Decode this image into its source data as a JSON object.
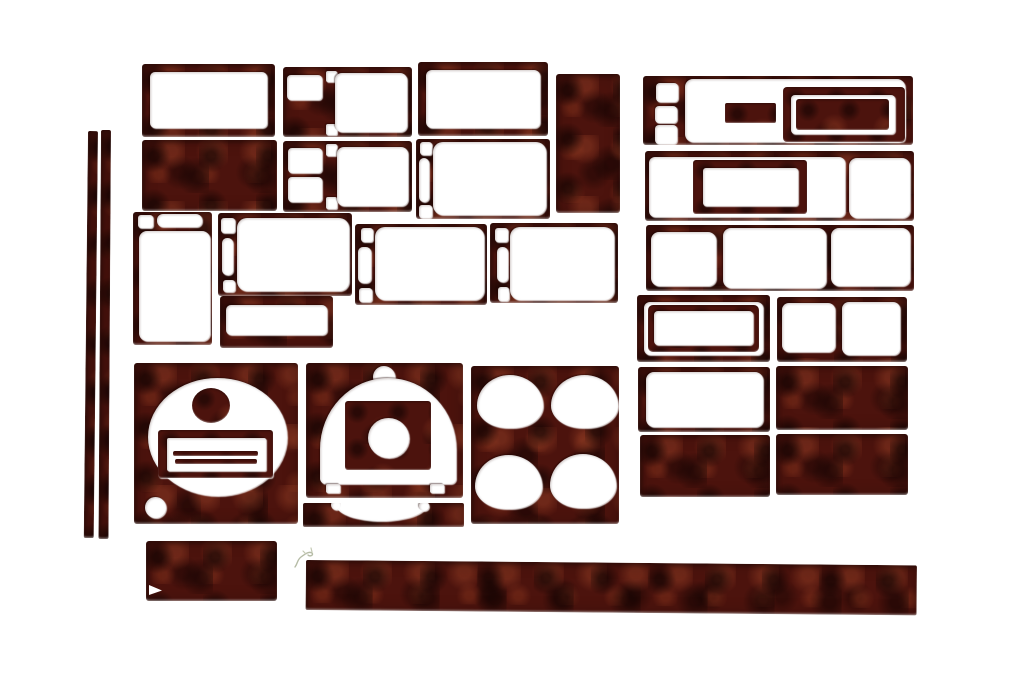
{
  "scene": {
    "type": "product-photo",
    "subject": "Glossy dark red burl wood-grain automotive dash trim kit, about 29 die-cut pieces arranged on a white background",
    "background_color": "#ffffff",
    "finish": {
      "name": "red burl walnut high-gloss",
      "base": "#4c130d",
      "shadow": "#1c0504",
      "mid": "#72281a",
      "highlight": "#9c4328",
      "specular": "#ffffff"
    },
    "piece_count": 29,
    "pieces": [
      {
        "id": "pillar-strip-left",
        "desc": "thin vertical pillar trim strip"
      },
      {
        "id": "pillar-strip-right",
        "desc": "thin vertical pillar trim strip"
      },
      {
        "id": "frame-top-left",
        "desc": "rectangular bezel with one large opening"
      },
      {
        "id": "switch-panel-upper",
        "desc": "bezel with small window, two tiny slots and large opening"
      },
      {
        "id": "vent-frame-top",
        "desc": "rectangular bezel with one large opening"
      },
      {
        "id": "blank-plate-vertical",
        "desc": "solid vertical blank plate"
      },
      {
        "id": "cluster-strip-frame",
        "desc": "long bezel with three small buttons openings, wide opening, inset block and double-frame display bezel"
      },
      {
        "id": "blank-plate-wide",
        "desc": "solid rectangular blank plate"
      },
      {
        "id": "switch-panel-lower",
        "desc": "bezel with two small windows, two tiny slots and large opening"
      },
      {
        "id": "hvac-frame",
        "desc": "bezel with slotted left column and large opening"
      },
      {
        "id": "radio-surround-frame",
        "desc": "long bezel with wide and small openings plus floating inner radio frame"
      },
      {
        "id": "gauge-pod-frame",
        "desc": "vertical bezel with two top slots and tall opening"
      },
      {
        "id": "window-switch-frame-a",
        "desc": "bezel with slotted left column and large opening"
      },
      {
        "id": "window-switch-frame-b",
        "desc": "bezel with slotted left column and large opening"
      },
      {
        "id": "window-switch-frame-c",
        "desc": "bezel with slotted left column and large opening"
      },
      {
        "id": "triple-opening-frame",
        "desc": "long bezel with three openings"
      },
      {
        "id": "small-display-frame",
        "desc": "small bezel with wide slot opening"
      },
      {
        "id": "double-bezel-frame",
        "desc": "nested double frame with center opening"
      },
      {
        "id": "dual-opening-frame",
        "desc": "bezel with two square openings"
      },
      {
        "id": "single-opening-frame",
        "desc": "bezel with one large opening"
      },
      {
        "id": "blank-plate-a",
        "desc": "solid rectangular blank plate"
      },
      {
        "id": "blank-plate-b",
        "desc": "solid rectangular blank plate"
      },
      {
        "id": "blank-plate-c",
        "desc": "solid rectangular blank plate"
      },
      {
        "id": "speedometer-panel",
        "desc": "square gauge panel with round dial cutout, top disc, slotted vent block and small hole"
      },
      {
        "id": "cluster-hood-panel",
        "desc": "panel with dome-shaped cluster cutout, top notch and inner block with round hole"
      },
      {
        "id": "cluster-lower-strip",
        "desc": "lower strip with scalloped arch cutout"
      },
      {
        "id": "cupholder-panel",
        "desc": "panel with four round cup-holder cutouts"
      },
      {
        "id": "blank-plate-small",
        "desc": "small solid blank plate"
      },
      {
        "id": "sill-strip-long",
        "desc": "long narrow sill trim strip"
      },
      {
        "id": "scratch-mark",
        "desc": "faint pencil scratch mark on backdrop"
      }
    ]
  }
}
